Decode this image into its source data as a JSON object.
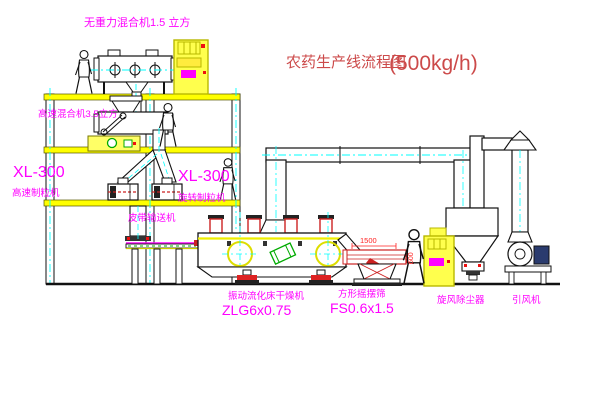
{
  "title": {
    "name": "农药生产线流程图",
    "capacity": "(500kg/h)"
  },
  "equipment_labels": {
    "gravity_mixer": "无重力混合机1.5 立方",
    "high_speed_mixer": "高速混合机3.5立方",
    "granulator_left": {
      "model": "XL-300",
      "name": "高速制粒机"
    },
    "granulator_right": {
      "model": "XL-300",
      "name": "旋转制粒机"
    },
    "belt_conveyor": "皮带输送机",
    "fluid_bed_dryer": {
      "name": "振动流化床干燥机",
      "model": "ZLG6x0.75"
    },
    "swing_sieve": {
      "name": "方形摇摆筛",
      "model": "FS0.6x1.5"
    },
    "cyclone": "旋风除尘器",
    "draft_fan": "引风机"
  },
  "dimensions": {
    "sieve_length": "1500",
    "sieve_height": "600"
  },
  "colors": {
    "label": "#ff00ff",
    "title": "#cc4a4a",
    "structure": "#ffff00",
    "dimension": "#ff2222",
    "centerline": "#00ffff"
  }
}
